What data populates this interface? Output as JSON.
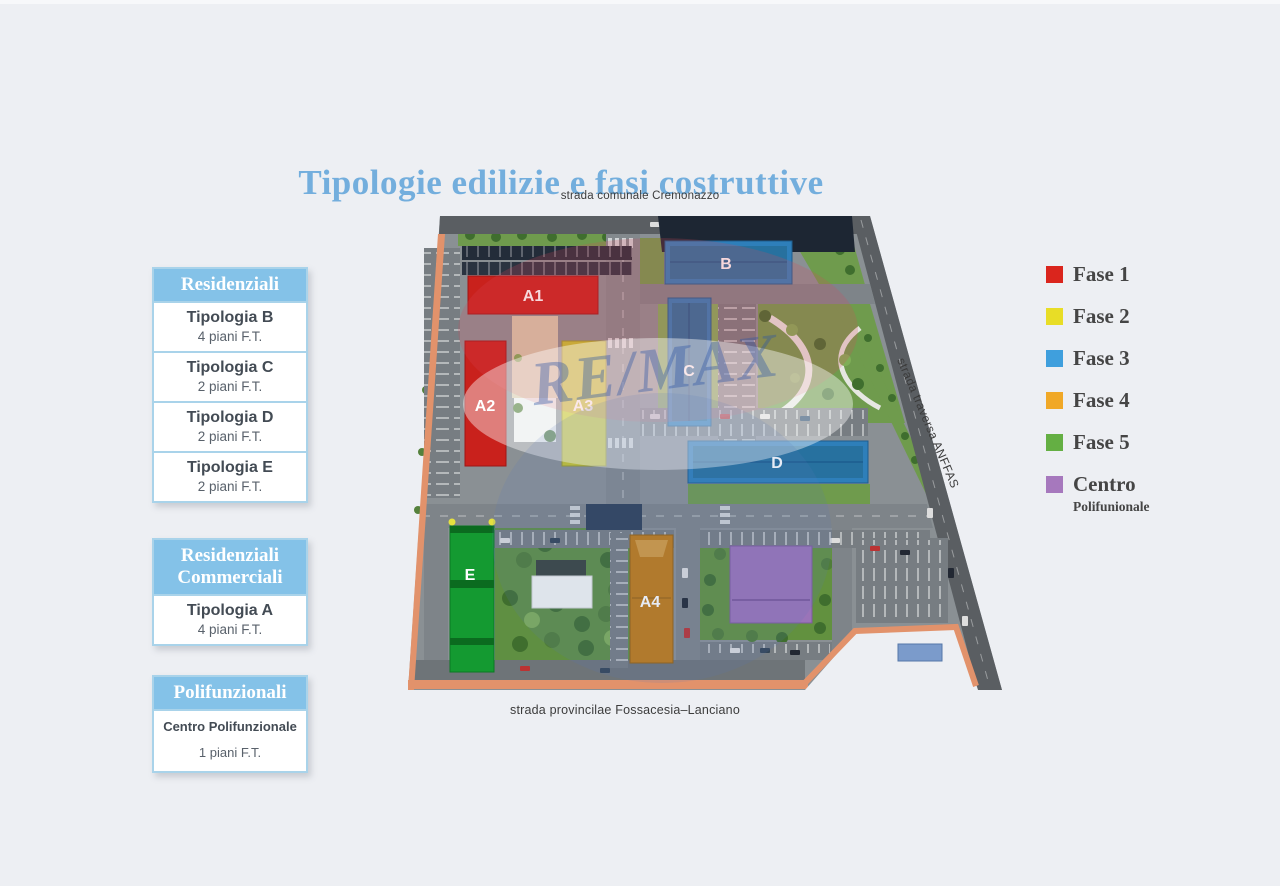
{
  "title": "Tipologie edilizie e fasi costruttive",
  "sidebar": {
    "groups": [
      {
        "header": "Residenziali",
        "rows": [
          {
            "title": "Tipologia B",
            "subtitle": "4 piani F.T."
          },
          {
            "title": "Tipologia C",
            "subtitle": "2 piani F.T."
          },
          {
            "title": "Tipologia D",
            "subtitle": "2 piani F.T."
          },
          {
            "title": "Tipologia E",
            "subtitle": "2 piani F.T."
          }
        ]
      },
      {
        "header": "Residenziali Commerciali",
        "rows": [
          {
            "title": "Tipologia A",
            "subtitle": "4 piani F.T."
          }
        ]
      },
      {
        "header": "Polifunzionali",
        "rows": [
          {
            "title": "Centro Polifunzionale",
            "subtitle": "1 piani F.T."
          }
        ]
      }
    ]
  },
  "legend": {
    "items": [
      {
        "label": "Fase 1",
        "color": "#da251d"
      },
      {
        "label": "Fase 2",
        "color": "#e8dd26"
      },
      {
        "label": "Fase 3",
        "color": "#3f9fdd"
      },
      {
        "label": "Fase 4",
        "color": "#f0a827"
      },
      {
        "label": "Fase 5",
        "color": "#64af43"
      },
      {
        "label": "Centro",
        "sublabel": "Polifunionale",
        "color": "#a678bd"
      }
    ]
  },
  "map": {
    "streets": {
      "top": "strada comunale Cremonazzo",
      "right": "strada traversa ANFFAS",
      "bottom": "strada provincilae Fossacesia–Lanciano"
    },
    "buildings": [
      {
        "label": "A1",
        "phase": "Fase 1",
        "color": "#c9211c"
      },
      {
        "label": "A2",
        "phase": "Fase 1",
        "color": "#c9211c"
      },
      {
        "label": "A3",
        "phase": "Fase 2",
        "color": "#c6c430"
      },
      {
        "label": "B",
        "phase": "Fase 3",
        "color": "#2e7fba"
      },
      {
        "label": "C",
        "phase": "Fase 3",
        "color": "#2e7fba"
      },
      {
        "label": "D",
        "phase": "Fase 3",
        "color": "#2e7fba"
      },
      {
        "label": "E",
        "phase": "Fase 5",
        "color": "#149a31"
      },
      {
        "label": "A4",
        "phase": "Fase 4",
        "color": "#c17b15"
      }
    ],
    "centro_color": "#9a74b8",
    "watermark": "RE/MAX"
  }
}
